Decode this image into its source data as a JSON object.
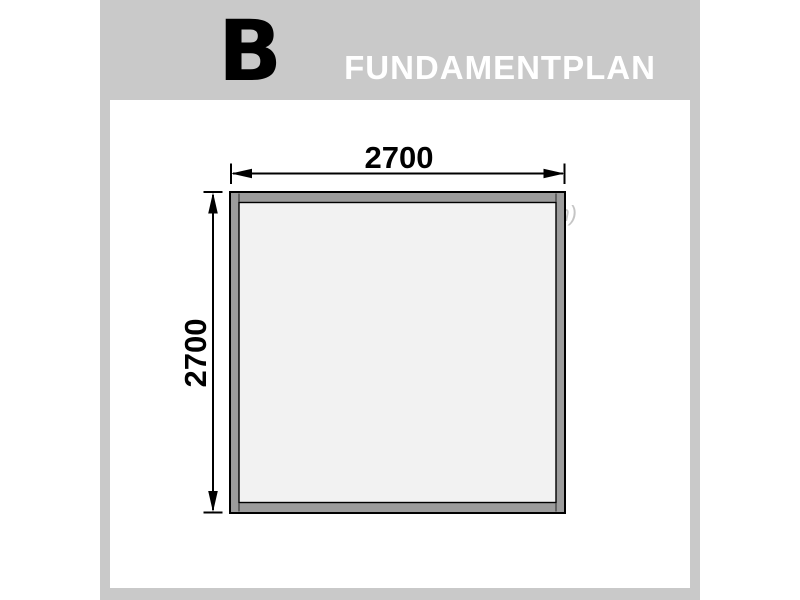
{
  "window": {
    "width": 800,
    "height": 600,
    "background": "#ffffff"
  },
  "header": {
    "section_letter": "B",
    "title": "FUNDAMENTPLAN",
    "band_color": "#c9c9c9",
    "letter_color": "#000000",
    "title_color": "#ffffff"
  },
  "content": {
    "units_note": "(in mm)",
    "units_note_color": "#c5c5c5"
  },
  "diagram": {
    "type": "foundation-plan-top-view",
    "shape": "square-frame",
    "width_label": "2700",
    "height_label": "2700",
    "units": "mm",
    "colors": {
      "beam_fill": "#9c9c9c",
      "interior_fill": "#f2f2f2",
      "outline": "#000000"
    }
  }
}
